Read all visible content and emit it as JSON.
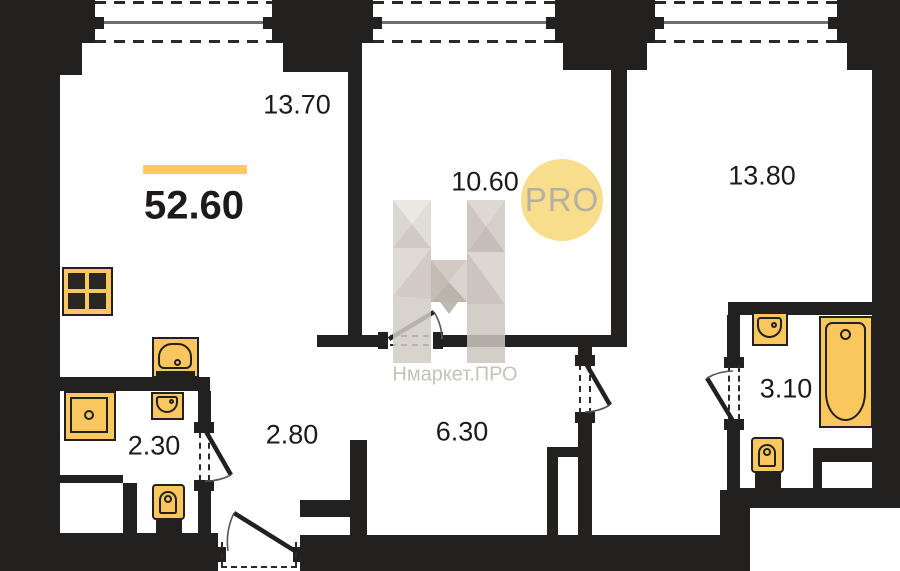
{
  "plan": {
    "total_area_label": "52.60",
    "rooms": [
      {
        "name": "room-13-70",
        "area": "13.70"
      },
      {
        "name": "room-10-60",
        "area": "10.60"
      },
      {
        "name": "room-13-80",
        "area": "13.80"
      },
      {
        "name": "room-2-30",
        "area": "2.30"
      },
      {
        "name": "room-2-80",
        "area": "2.80"
      },
      {
        "name": "room-6-30",
        "area": "6.30"
      },
      {
        "name": "room-3-10",
        "area": "3.10"
      }
    ],
    "watermark": {
      "circle_label": "PRO",
      "brand_text": "Нмаркет.ПРО"
    },
    "colors": {
      "wall": "#232120",
      "fixture_yellow": "#f9c75e",
      "accent_bar": "#fbcb5c",
      "pro_circle": "#f8dd8c",
      "pro_text": "#b5b0a4",
      "brand_text": "#c8c2b8"
    },
    "fixtures": [
      {
        "name": "stove-icon",
        "room": "kitchen-living"
      },
      {
        "name": "kitchen-sink-icon",
        "room": "kitchen-living"
      },
      {
        "name": "shower-tray-icon",
        "room": "room-2-30"
      },
      {
        "name": "washbasin-icon",
        "room": "room-2-30"
      },
      {
        "name": "toilet-icon",
        "room": "room-2-30"
      },
      {
        "name": "washbasin-icon",
        "room": "room-3-10"
      },
      {
        "name": "bathtub-icon",
        "room": "room-3-10"
      },
      {
        "name": "toilet-icon",
        "room": "room-3-10"
      }
    ]
  }
}
